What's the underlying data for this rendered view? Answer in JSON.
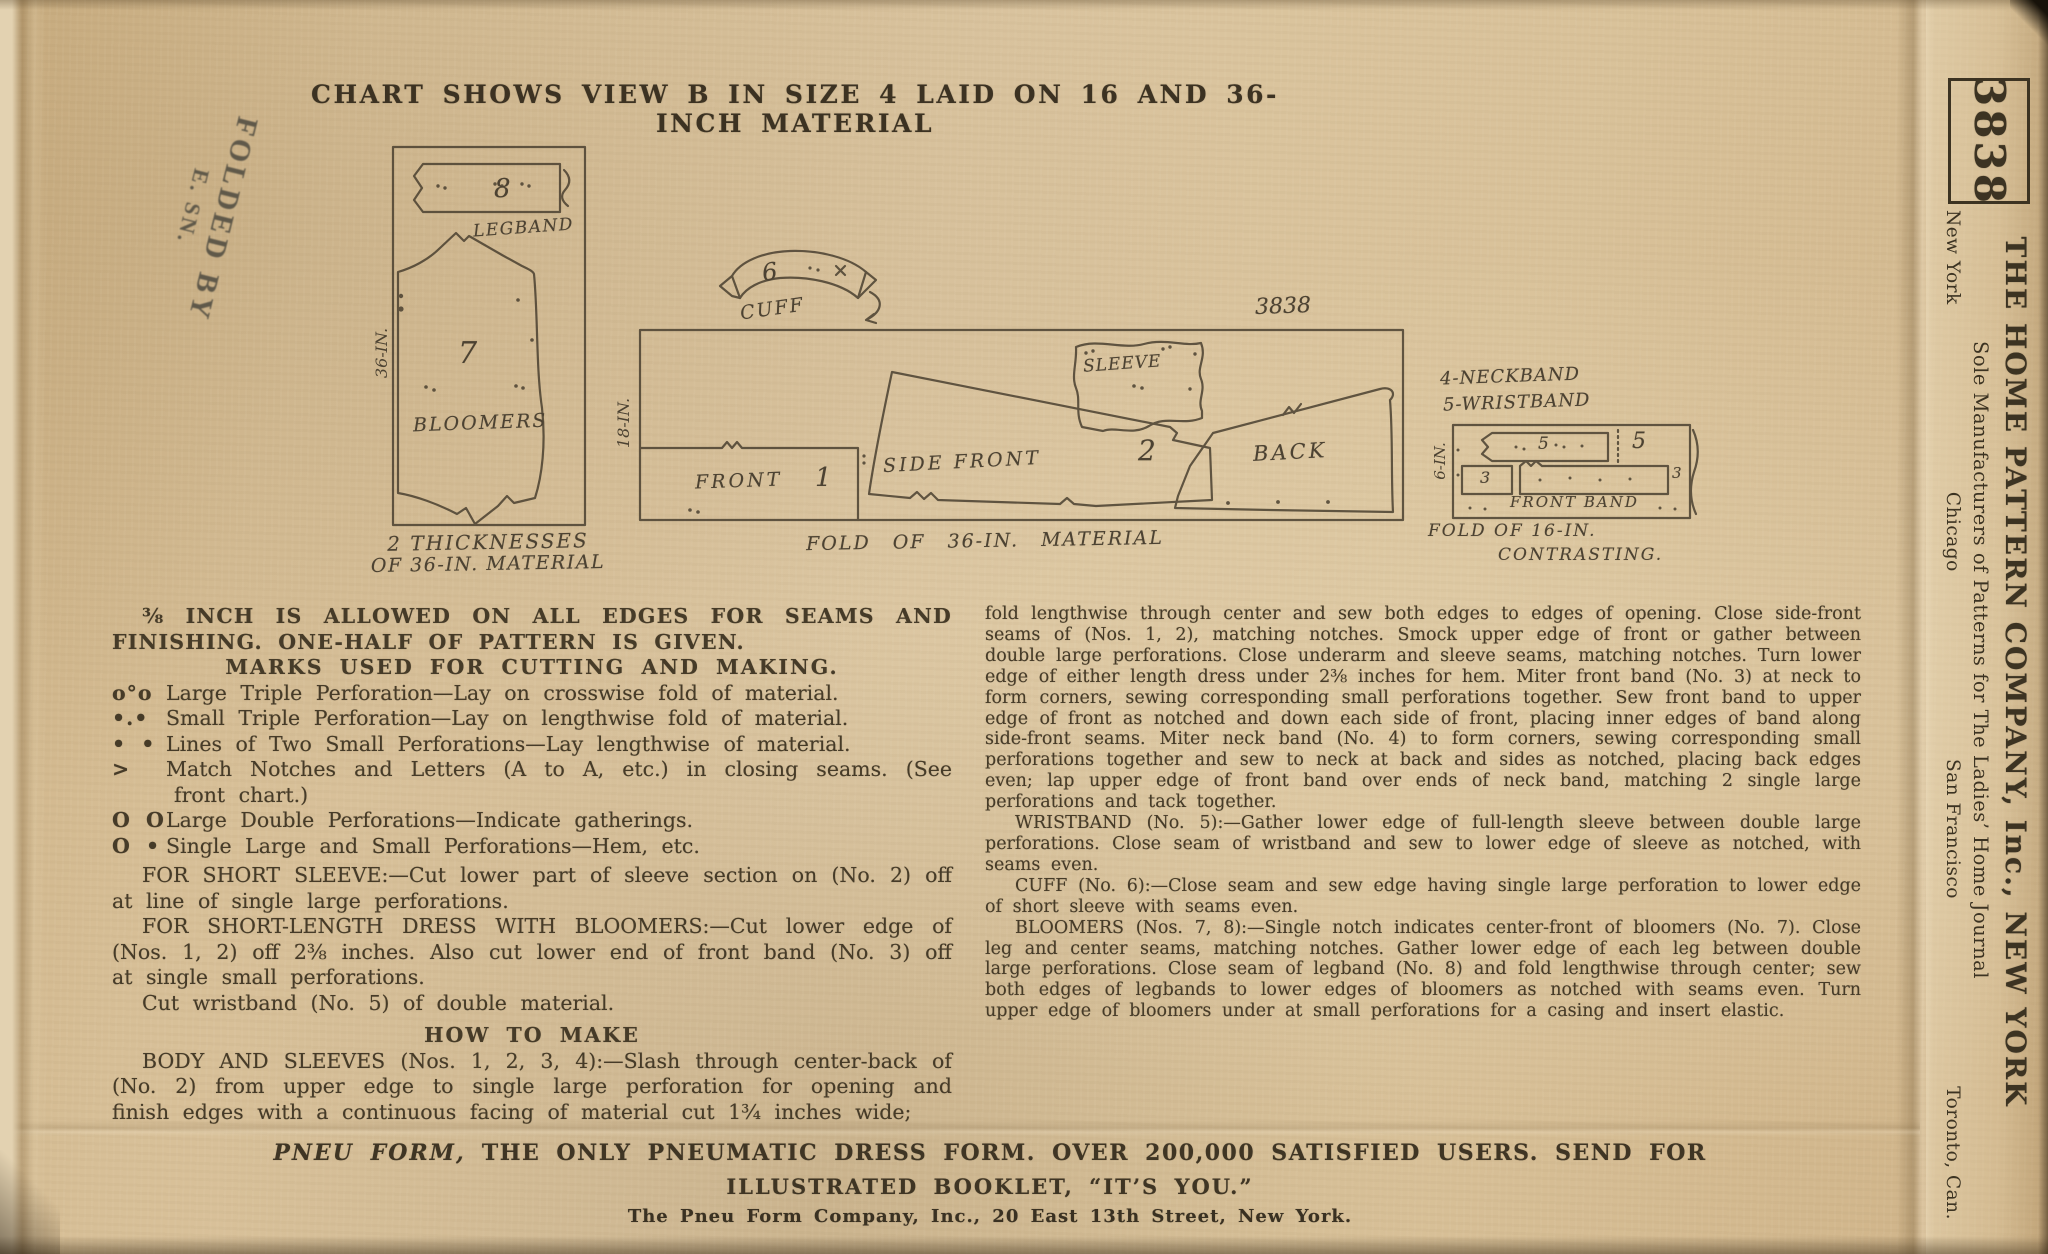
{
  "colors": {
    "paper": "#d9c29a",
    "ink": "#463b28",
    "diagram_ink": "#4a4030",
    "stamp_ink": "#55534a"
  },
  "title": "CHART SHOWS VIEW B IN SIZE 4 LAID ON 16 AND 36-INCH MATERIAL",
  "stamp": {
    "line1": "FOLDED BY",
    "line2": "E. SN."
  },
  "chart": {
    "left_layout": {
      "legband_number": "8",
      "legband_label": "LEGBAND",
      "bloomers_number": "7",
      "bloomers_label": "BLOOMERS",
      "width_label": "36-IN.",
      "caption_line1": "2 THICKNESSES",
      "caption_line2": "OF 36-IN. MATERIAL"
    },
    "middle_layout": {
      "cuff_number": "6",
      "cuff_label": "CUFF",
      "pattern_number": "3838",
      "width_label": "18-IN.",
      "front_label": "FRONT",
      "front_number": "1",
      "side_front_label": "SIDE FRONT",
      "side_front_number": "2",
      "sleeve_label": "SLEEVE",
      "back_label": "BACK",
      "caption": "FOLD OF 36-IN. MATERIAL"
    },
    "right_layout": {
      "legend_line1": "4-NECKBAND",
      "legend_line2": "5-WRISTBAND",
      "width_label": "6-IN.",
      "band5_number": "5",
      "big5_number": "5",
      "num3_left": "3",
      "num3_right": "3",
      "front_band_label": "FRONT BAND",
      "caption_line1": "FOLD OF 16-IN.",
      "caption_line2": "CONTRASTING."
    }
  },
  "left_col": {
    "intro": "⅜ INCH IS ALLOWED ON ALL EDGES FOR SEAMS AND FINISHING. ONE-HALF OF PATTERN IS GIVEN.",
    "marks_heading": "MARKS USED FOR CUTTING AND MAKING.",
    "marks": [
      {
        "symbol": "o°o",
        "text": "Large Triple Perforation—Lay on crosswise fold of material."
      },
      {
        "symbol": "•.•",
        "text": "Small Triple Perforation—Lay on lengthwise fold of material."
      },
      {
        "symbol": "• •",
        "text": "Lines of Two Small Perforations—Lay lengthwise of material."
      },
      {
        "symbol": ">",
        "text": "Match Notches and Letters (A to A, etc.) in closing seams. (See front chart.)"
      },
      {
        "symbol": "O O",
        "text": "Large Double Perforations—Indicate gatherings."
      },
      {
        "symbol": "O •",
        "text": "Single Large and Small Perforations—Hem, etc."
      }
    ],
    "para_short_sleeve": "FOR SHORT SLEEVE:—Cut lower part of sleeve section on (No. 2) off at line of single large perforations.",
    "para_short_dress": "FOR SHORT-LENGTH DRESS WITH BLOOMERS:—Cut lower edge of (Nos. 1, 2) off 2⅜ inches. Also cut lower end of front band (No. 3) off at single small perforations.",
    "para_wristband": "Cut wristband (No. 5) of double material.",
    "how_heading": "HOW TO MAKE",
    "para_body": "BODY AND SLEEVES (Nos. 1, 2, 3, 4):—Slash through center-back of (No. 2) from upper edge to single large perforation for opening and finish edges with a continuous facing of material cut 1¾ inches wide;"
  },
  "right_col": {
    "para1": "fold lengthwise through center and sew both edges to edges of opening. Close side-front seams of (Nos. 1, 2), matching notches. Smock upper edge of front or gather between double large perforations. Close underarm and sleeve seams, matching notches. Turn lower edge of either length dress under 2⅜ inches for hem. Miter front band (No. 3) at neck to form corners, sewing corresponding small perforations together. Sew front band to upper edge of front as notched and down each side of front, placing inner edges of band along side-front seams. Miter neck band (No. 4) to form corners, sewing corresponding small perforations together and sew to neck at back and sides as notched, placing back edges even; lap upper edge of front band over ends of neck band, matching 2 single large perforations and tack together.",
    "para2": "WRISTBAND (No. 5):—Gather lower edge of full-length sleeve between double large perforations. Close seam of wristband and sew to lower edge of sleeve as notched, with seams even.",
    "para3": "CUFF (No. 6):—Close seam and sew edge having single large perforation to lower edge of short sleeve with seams even.",
    "para4": "BLOOMERS (Nos. 7, 8):—Single notch indicates center-front of bloomers (No. 7). Close leg and center seams, matching notches. Gather lower edge of each leg between double large perforations. Close seam of legband (No. 8) and fold lengthwise through center; sew both edges of legbands to lower edges of bloomers as notched with seams even. Turn upper edge of bloomers under at small perforations for a casing and insert elastic."
  },
  "footer": {
    "line1_lead": "PNEU FORM,",
    "line1_rest": " THE ONLY PNEUMATIC DRESS FORM. OVER 200,000 SATISFIED USERS. SEND FOR",
    "line2": "ILLUSTRATED BOOKLET, “IT’S YOU.”",
    "line3": "The Pneu Form Company, Inc., 20 East 13th Street, New York."
  },
  "sidebar": {
    "pattern_number": "3838",
    "company": "THE HOME PATTERN COMPANY, Inc., NEW YORK",
    "subtitle": "Sole Manufacturers of Patterns for The Ladies’ Home Journal",
    "cities": [
      "New York",
      "Chicago",
      "San Francisco",
      "Toronto, Can."
    ]
  }
}
